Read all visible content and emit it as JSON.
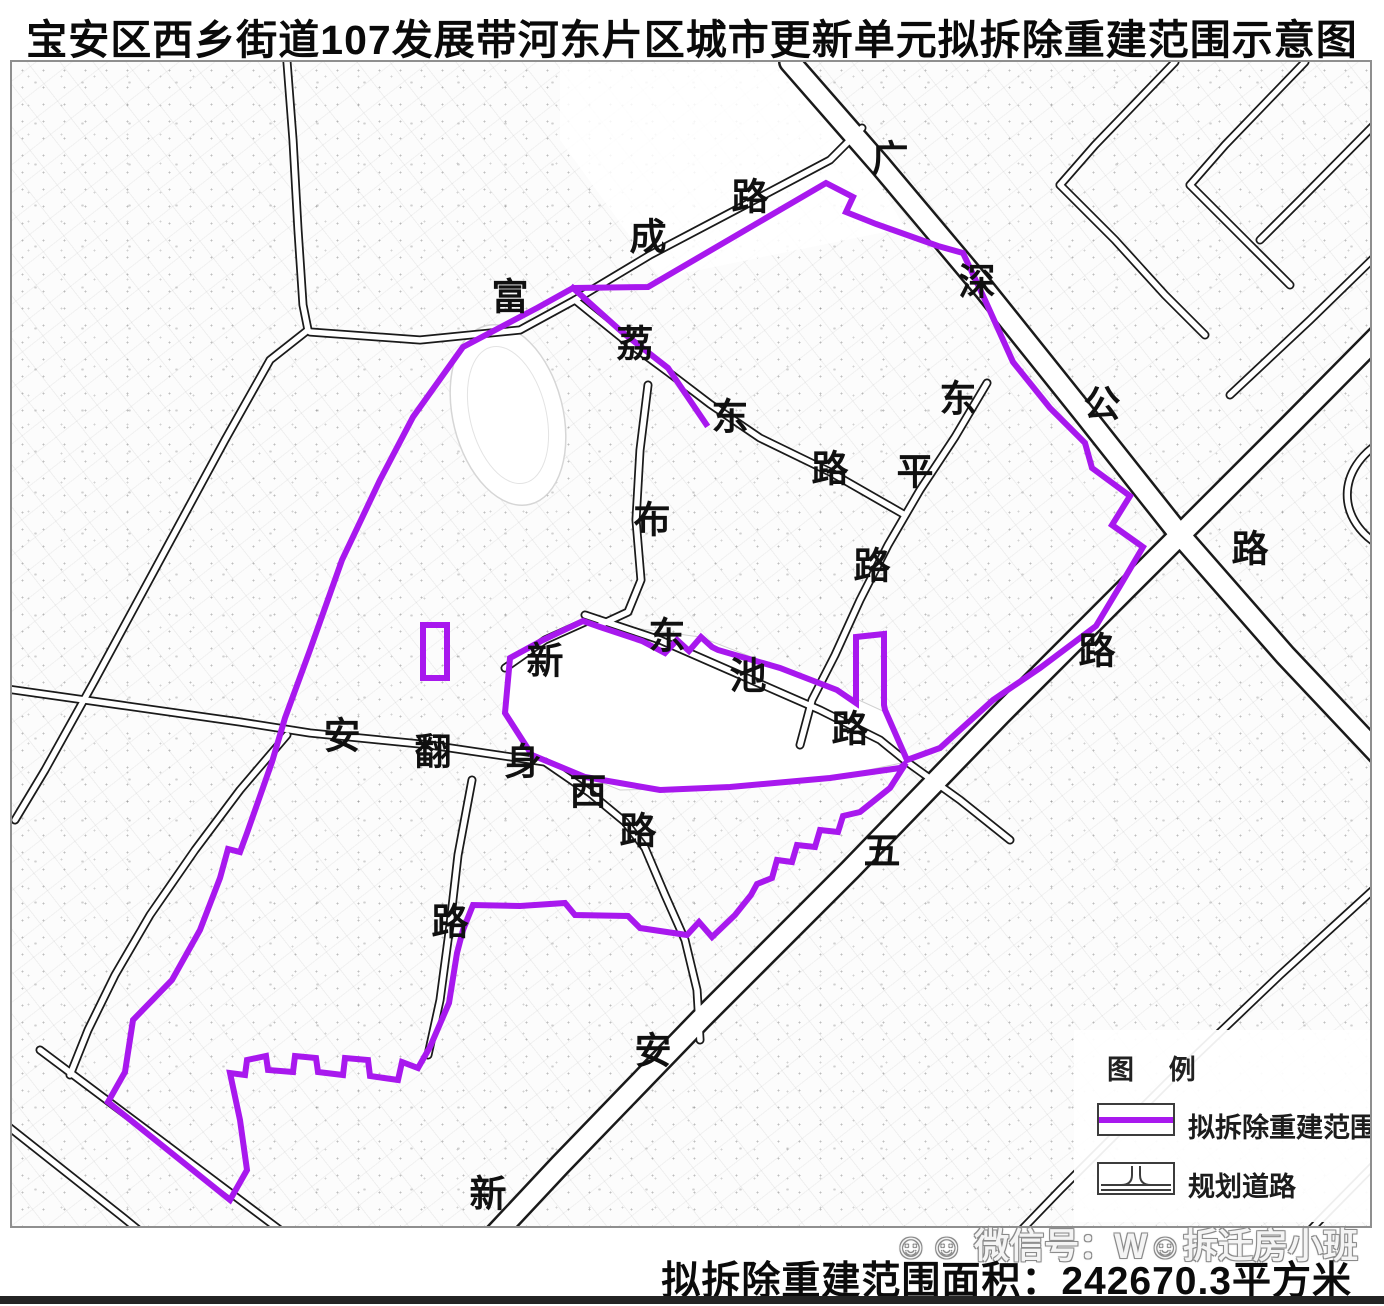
{
  "title": "宝安区西乡街道107发展带河东片区城市更新单元拟拆除重建范围示意图",
  "legend": {
    "title": "图 例",
    "items": [
      {
        "label": "拟拆除重建范围",
        "type": "boundary-line-symbol",
        "color": "#A818EE"
      },
      {
        "label": "规划道路",
        "type": "planned-road-symbol",
        "color": "#3c3c3c"
      }
    ]
  },
  "footer": {
    "watermark": "☺☺ 微信号：W☺拆迁房小班",
    "area_text": "拟拆除重建范围面积：242670.3平方米"
  },
  "map": {
    "colors": {
      "boundary": "#A818EE",
      "road": "#1a1a1a",
      "road_fill": "#ffffff"
    },
    "road_labels": [
      {
        "t": "广",
        "x": 890,
        "y": 160
      },
      {
        "t": "深",
        "x": 977,
        "y": 283
      },
      {
        "t": "公",
        "x": 1102,
        "y": 405
      },
      {
        "t": "路",
        "x": 1250,
        "y": 550
      },
      {
        "t": "路",
        "x": 750,
        "y": 198
      },
      {
        "t": "成",
        "x": 648,
        "y": 238
      },
      {
        "t": "富",
        "x": 510,
        "y": 298
      },
      {
        "t": "荔",
        "x": 635,
        "y": 345
      },
      {
        "t": "东",
        "x": 730,
        "y": 418
      },
      {
        "t": "路",
        "x": 830,
        "y": 470
      },
      {
        "t": "布",
        "x": 652,
        "y": 521
      },
      {
        "t": "东",
        "x": 958,
        "y": 400
      },
      {
        "t": "平",
        "x": 915,
        "y": 473
      },
      {
        "t": "路",
        "x": 872,
        "y": 567
      },
      {
        "t": "新",
        "x": 545,
        "y": 662
      },
      {
        "t": "东",
        "x": 667,
        "y": 637
      },
      {
        "t": "池",
        "x": 748,
        "y": 677
      },
      {
        "t": "路",
        "x": 850,
        "y": 730
      },
      {
        "t": "安",
        "x": 342,
        "y": 737
      },
      {
        "t": "翻",
        "x": 433,
        "y": 753
      },
      {
        "t": "身",
        "x": 523,
        "y": 763
      },
      {
        "t": "西",
        "x": 588,
        "y": 793
      },
      {
        "t": "路",
        "x": 638,
        "y": 832
      },
      {
        "t": "路",
        "x": 450,
        "y": 923
      },
      {
        "t": "五",
        "x": 882,
        "y": 852
      },
      {
        "t": "安",
        "x": 653,
        "y": 1052
      },
      {
        "t": "新",
        "x": 488,
        "y": 1195
      },
      {
        "t": "路",
        "x": 1097,
        "y": 652
      }
    ]
  }
}
